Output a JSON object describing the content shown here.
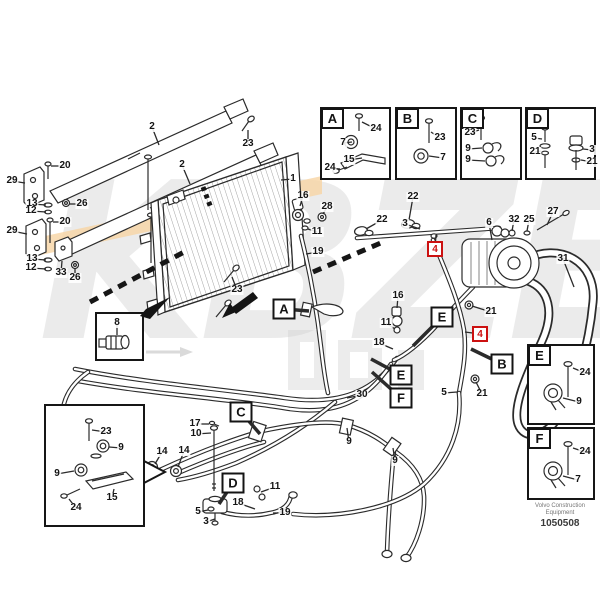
{
  "publisher": {
    "line1": "Volvo Construction",
    "line2": "Equipment",
    "number": "1050508"
  },
  "watermark": {
    "text": "KBZE"
  },
  "colors": {
    "flag_red": "#cc1111",
    "watermark_band": "#f7d5a4",
    "watermark_gray": "#cdcdcd",
    "line": "#2b2b2b"
  },
  "panels": {
    "A": "A",
    "B": "B",
    "C": "C",
    "D": "D",
    "E": "E",
    "F": "F"
  },
  "markers": [
    {
      "t": "A",
      "x": 284,
      "y": 309,
      "lead": [
        309,
        311
      ]
    },
    {
      "t": "E",
      "x": 442,
      "y": 317,
      "lead": [
        413,
        346
      ]
    },
    {
      "t": "B",
      "x": 502,
      "y": 364,
      "lead": [
        471,
        349
      ]
    },
    {
      "t": "E",
      "x": 401,
      "y": 375,
      "lead": [
        371,
        359
      ]
    },
    {
      "t": "F",
      "x": 401,
      "y": 398,
      "lead": [
        372,
        372
      ]
    },
    {
      "t": "C",
      "x": 241,
      "y": 412,
      "lead": [
        260,
        434
      ]
    },
    {
      "t": "D",
      "x": 233,
      "y": 483,
      "lead": [
        219,
        504
      ]
    }
  ],
  "flags": [
    {
      "t": "4",
      "x": 435,
      "y": 249,
      "lead": [
        436,
        235
      ]
    },
    {
      "t": "4",
      "x": 480,
      "y": 334,
      "lead": [
        465,
        332
      ]
    }
  ],
  "callouts": [
    {
      "t": "1",
      "x": 293,
      "y": 179,
      "lead": [
        281,
        180
      ]
    },
    {
      "t": "2",
      "x": 152,
      "y": 127,
      "lead": [
        159,
        145
      ]
    },
    {
      "t": "2",
      "x": 182,
      "y": 165,
      "lead": [
        190,
        184
      ]
    },
    {
      "t": "23",
      "x": 248,
      "y": 144,
      "lead": [
        248,
        130
      ]
    },
    {
      "t": "20",
      "x": 65,
      "y": 166,
      "lead": [
        51,
        166
      ]
    },
    {
      "t": "20",
      "x": 65,
      "y": 222,
      "lead": [
        53,
        222
      ]
    },
    {
      "t": "29",
      "x": 12,
      "y": 181,
      "lead": [
        25,
        183
      ]
    },
    {
      "t": "29",
      "x": 12,
      "y": 231,
      "lead": [
        27,
        234
      ]
    },
    {
      "t": "13",
      "x": 32,
      "y": 204,
      "lead": [
        46,
        205
      ]
    },
    {
      "t": "12",
      "x": 31,
      "y": 211,
      "lead": [
        46,
        212
      ]
    },
    {
      "t": "26",
      "x": 82,
      "y": 204,
      "lead": [
        69,
        204
      ]
    },
    {
      "t": "13",
      "x": 32,
      "y": 259,
      "lead": [
        46,
        260
      ]
    },
    {
      "t": "12",
      "x": 31,
      "y": 268,
      "lead": [
        46,
        269
      ]
    },
    {
      "t": "33",
      "x": 61,
      "y": 273,
      "lead": [
        62,
        261
      ]
    },
    {
      "t": "26",
      "x": 75,
      "y": 278,
      "lead": [
        75,
        268
      ]
    },
    {
      "t": "23",
      "x": 237,
      "y": 290,
      "lead": [
        232,
        277
      ]
    },
    {
      "t": "8",
      "x": 117,
      "y": 323,
      "lead": [
        117,
        335
      ]
    },
    {
      "t": "16",
      "x": 303,
      "y": 196,
      "lead": [
        300,
        206
      ]
    },
    {
      "t": "28",
      "x": 327,
      "y": 207,
      "lead": [
        323,
        214
      ]
    },
    {
      "t": "11",
      "x": 317,
      "y": 232,
      "lead": [
        308,
        229
      ]
    },
    {
      "t": "19",
      "x": 318,
      "y": 252,
      "lead": [
        306,
        254
      ]
    },
    {
      "t": "22",
      "x": 413,
      "y": 197,
      "lead": [
        409,
        220
      ]
    },
    {
      "t": "22",
      "x": 382,
      "y": 220,
      "lead": [
        366,
        229
      ]
    },
    {
      "t": "3",
      "x": 405,
      "y": 224,
      "lead": [
        420,
        229
      ]
    },
    {
      "t": "6",
      "x": 489,
      "y": 223,
      "lead": [
        492,
        240
      ]
    },
    {
      "t": "32",
      "x": 514,
      "y": 220,
      "lead": [
        512,
        231
      ]
    },
    {
      "t": "25",
      "x": 529,
      "y": 220,
      "lead": [
        527,
        231
      ]
    },
    {
      "t": "27",
      "x": 553,
      "y": 212,
      "lead": [
        547,
        225
      ]
    },
    {
      "t": "31",
      "x": 563,
      "y": 259,
      "lead": [
        574,
        287
      ]
    },
    {
      "t": "21",
      "x": 491,
      "y": 312,
      "lead": [
        472,
        306
      ]
    },
    {
      "t": "16",
      "x": 398,
      "y": 296,
      "lead": [
        397,
        308
      ]
    },
    {
      "t": "11",
      "x": 386,
      "y": 323,
      "lead": [
        395,
        329
      ]
    },
    {
      "t": "18",
      "x": 379,
      "y": 343,
      "lead": [
        393,
        349
      ]
    },
    {
      "t": "21",
      "x": 482,
      "y": 394,
      "lead": [
        476,
        382
      ]
    },
    {
      "t": "5",
      "x": 444,
      "y": 393,
      "lead": [
        457,
        392
      ]
    },
    {
      "t": "30",
      "x": 362,
      "y": 395,
      "lead": [
        347,
        398
      ]
    },
    {
      "t": "9",
      "x": 349,
      "y": 442,
      "lead": [
        347,
        428
      ]
    },
    {
      "t": "9",
      "x": 395,
      "y": 461,
      "lead": [
        393,
        448
      ]
    },
    {
      "t": "17",
      "x": 195,
      "y": 424,
      "lead": [
        209,
        424
      ]
    },
    {
      "t": "10",
      "x": 196,
      "y": 434,
      "lead": [
        211,
        433
      ]
    },
    {
      "t": "14",
      "x": 162,
      "y": 452,
      "lead": [
        155,
        464
      ]
    },
    {
      "t": "14",
      "x": 184,
      "y": 451,
      "lead": [
        178,
        467
      ]
    },
    {
      "t": "11",
      "x": 275,
      "y": 487,
      "lead": [
        261,
        492
      ]
    },
    {
      "t": "18",
      "x": 238,
      "y": 503,
      "lead": [
        255,
        509
      ]
    },
    {
      "t": "19",
      "x": 285,
      "y": 513,
      "lead": [
        273,
        513
      ]
    },
    {
      "t": "5",
      "x": 198,
      "y": 512,
      "lead": [
        208,
        510
      ]
    },
    {
      "t": "3",
      "x": 206,
      "y": 522,
      "lead": [
        215,
        519
      ]
    },
    {
      "t": "24",
      "x": 376,
      "y": 129,
      "lead": [
        362,
        122
      ]
    },
    {
      "t": "7",
      "x": 343,
      "y": 143,
      "lead": [
        352,
        142
      ]
    },
    {
      "t": "15",
      "x": 349,
      "y": 160,
      "lead": [
        362,
        158
      ]
    },
    {
      "t": "24",
      "x": 330,
      "y": 168,
      "lead": [
        340,
        169
      ]
    },
    {
      "t": "23",
      "x": 440,
      "y": 138,
      "lead": [
        431,
        132
      ]
    },
    {
      "t": "7",
      "x": 443,
      "y": 158,
      "lead": [
        429,
        156
      ]
    },
    {
      "t": "23",
      "x": 470,
      "y": 133,
      "lead": [
        479,
        130
      ]
    },
    {
      "t": "9",
      "x": 468,
      "y": 149,
      "lead": [
        482,
        148
      ]
    },
    {
      "t": "9",
      "x": 468,
      "y": 160,
      "lead": [
        485,
        161
      ]
    },
    {
      "t": "5",
      "x": 534,
      "y": 138,
      "lead": [
        542,
        139
      ]
    },
    {
      "t": "21",
      "x": 535,
      "y": 152,
      "lead": [
        541,
        151
      ]
    },
    {
      "t": "3",
      "x": 592,
      "y": 150,
      "lead": [
        583,
        149
      ]
    },
    {
      "t": "21",
      "x": 592,
      "y": 162,
      "lead": [
        581,
        160
      ]
    },
    {
      "t": "24",
      "x": 585,
      "y": 373,
      "lead": [
        573,
        368
      ]
    },
    {
      "t": "9",
      "x": 579,
      "y": 402,
      "lead": [
        563,
        398
      ]
    },
    {
      "t": "24",
      "x": 585,
      "y": 452,
      "lead": [
        573,
        448
      ]
    },
    {
      "t": "7",
      "x": 578,
      "y": 480,
      "lead": [
        563,
        476
      ]
    },
    {
      "t": "23",
      "x": 106,
      "y": 432,
      "lead": [
        92,
        430
      ]
    },
    {
      "t": "9",
      "x": 121,
      "y": 448,
      "lead": [
        109,
        447
      ]
    },
    {
      "t": "9",
      "x": 57,
      "y": 474,
      "lead": [
        74,
        471
      ]
    },
    {
      "t": "15",
      "x": 112,
      "y": 498,
      "lead": [
        114,
        489
      ]
    },
    {
      "t": "24",
      "x": 76,
      "y": 508,
      "lead": [
        69,
        499
      ]
    }
  ]
}
